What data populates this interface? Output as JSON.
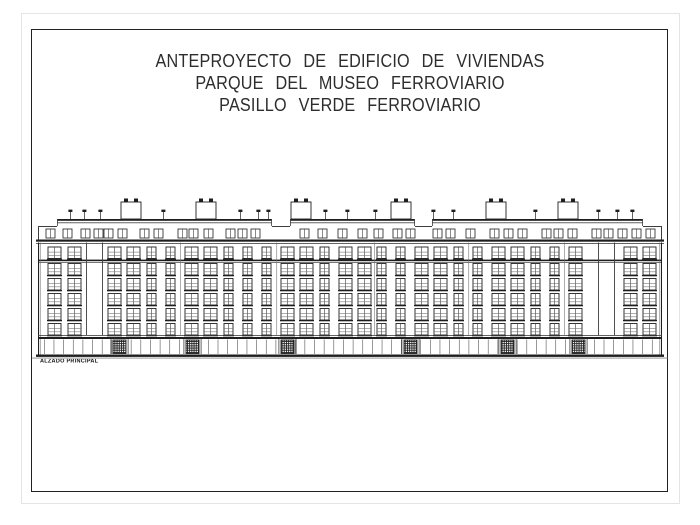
{
  "title_block": {
    "lines": [
      "ANTEPROYECTO DE EDIFICIO DE VIVIENDAS",
      "PARQUE DEL MUSEO FERROVIARIO",
      "PASILLO VERDE FERROVIARIO"
    ]
  },
  "caption": "ALZADO PRINCIPAL",
  "colors": {
    "paper": "#ffffff",
    "frame": "#212121",
    "ink": "#1e1e1e",
    "ink_mid": "#3d3d3d",
    "ink_light": "#6a6a6a",
    "edge": "#e4e4e4",
    "hatch": "#222222"
  },
  "drawing": {
    "facade_left": 38,
    "facade_right": 662,
    "roof_y": 219,
    "roof_blocks": [
      [
        57,
        272
      ],
      [
        290,
        415
      ],
      [
        432,
        643
      ]
    ],
    "end_roof_y": 226,
    "end_segments": [
      [
        38,
        57
      ],
      [
        272,
        290
      ],
      [
        415,
        432
      ],
      [
        643,
        662
      ]
    ],
    "chimney_w": 20,
    "chimney_top": 202,
    "chimneys": [
      {
        "x": 121
      },
      {
        "x": 196
      },
      {
        "x": 291
      },
      {
        "x": 391
      },
      {
        "x": 486
      },
      {
        "x": 558
      }
    ],
    "vent_top": 212,
    "vents": [
      70,
      84,
      100,
      163,
      240,
      258,
      268,
      325,
      347,
      375,
      433,
      453,
      535,
      598,
      617,
      632
    ],
    "attic_win_y": 229,
    "attic_win_w": 9,
    "attic_win_h": 9,
    "attic_win_x": [
      46,
      63,
      81,
      94,
      104,
      118,
      140,
      154,
      178,
      189,
      204,
      226,
      238,
      251,
      300,
      318,
      338,
      358,
      374,
      393,
      406,
      433,
      446,
      466,
      490,
      504,
      518,
      542,
      554,
      568,
      592,
      604,
      618,
      632,
      646
    ],
    "cornice_y": 239.5,
    "stringcourse_y": 259.6,
    "rows": [
      247,
      263.5,
      278.5,
      293.5,
      308.5,
      323.5
    ],
    "row_h": 11.5,
    "columns": [
      {
        "x": 48,
        "w": 13
      },
      {
        "x": 68,
        "w": 13
      },
      {
        "x": 108,
        "w": 13
      },
      {
        "x": 127,
        "w": 13
      },
      {
        "x": 147,
        "w": 9
      },
      {
        "x": 166,
        "w": 9
      },
      {
        "x": 185,
        "w": 13
      },
      {
        "x": 204,
        "w": 13
      },
      {
        "x": 224,
        "w": 9
      },
      {
        "x": 243,
        "w": 9
      },
      {
        "x": 262,
        "w": 9
      },
      {
        "x": 281,
        "w": 13
      },
      {
        "x": 300,
        "w": 13
      },
      {
        "x": 320,
        "w": 9
      },
      {
        "x": 339,
        "w": 13
      },
      {
        "x": 358,
        "w": 13
      },
      {
        "x": 377,
        "w": 9
      },
      {
        "x": 396,
        "w": 9
      },
      {
        "x": 415,
        "w": 13
      },
      {
        "x": 434,
        "w": 13
      },
      {
        "x": 454,
        "w": 9
      },
      {
        "x": 473,
        "w": 9
      },
      {
        "x": 492,
        "w": 13
      },
      {
        "x": 511,
        "w": 13
      },
      {
        "x": 531,
        "w": 9
      },
      {
        "x": 550,
        "w": 9
      },
      {
        "x": 569,
        "w": 13
      },
      {
        "x": 624,
        "w": 13
      },
      {
        "x": 643,
        "w": 13
      }
    ],
    "pier_edges": [
      86,
      102,
      598,
      614
    ],
    "panel_joints": [
      180,
      276.5,
      374,
      468.5,
      564
    ],
    "ground_top": 335,
    "ground_y": 339,
    "ground_bottom": 354,
    "ground_mullion_pitch": 9.65,
    "door_w": 13,
    "door_y": 340,
    "door_h": 13.5,
    "door_x": [
      113,
      186,
      281,
      404,
      501,
      572
    ],
    "base_y": 354.5
  }
}
